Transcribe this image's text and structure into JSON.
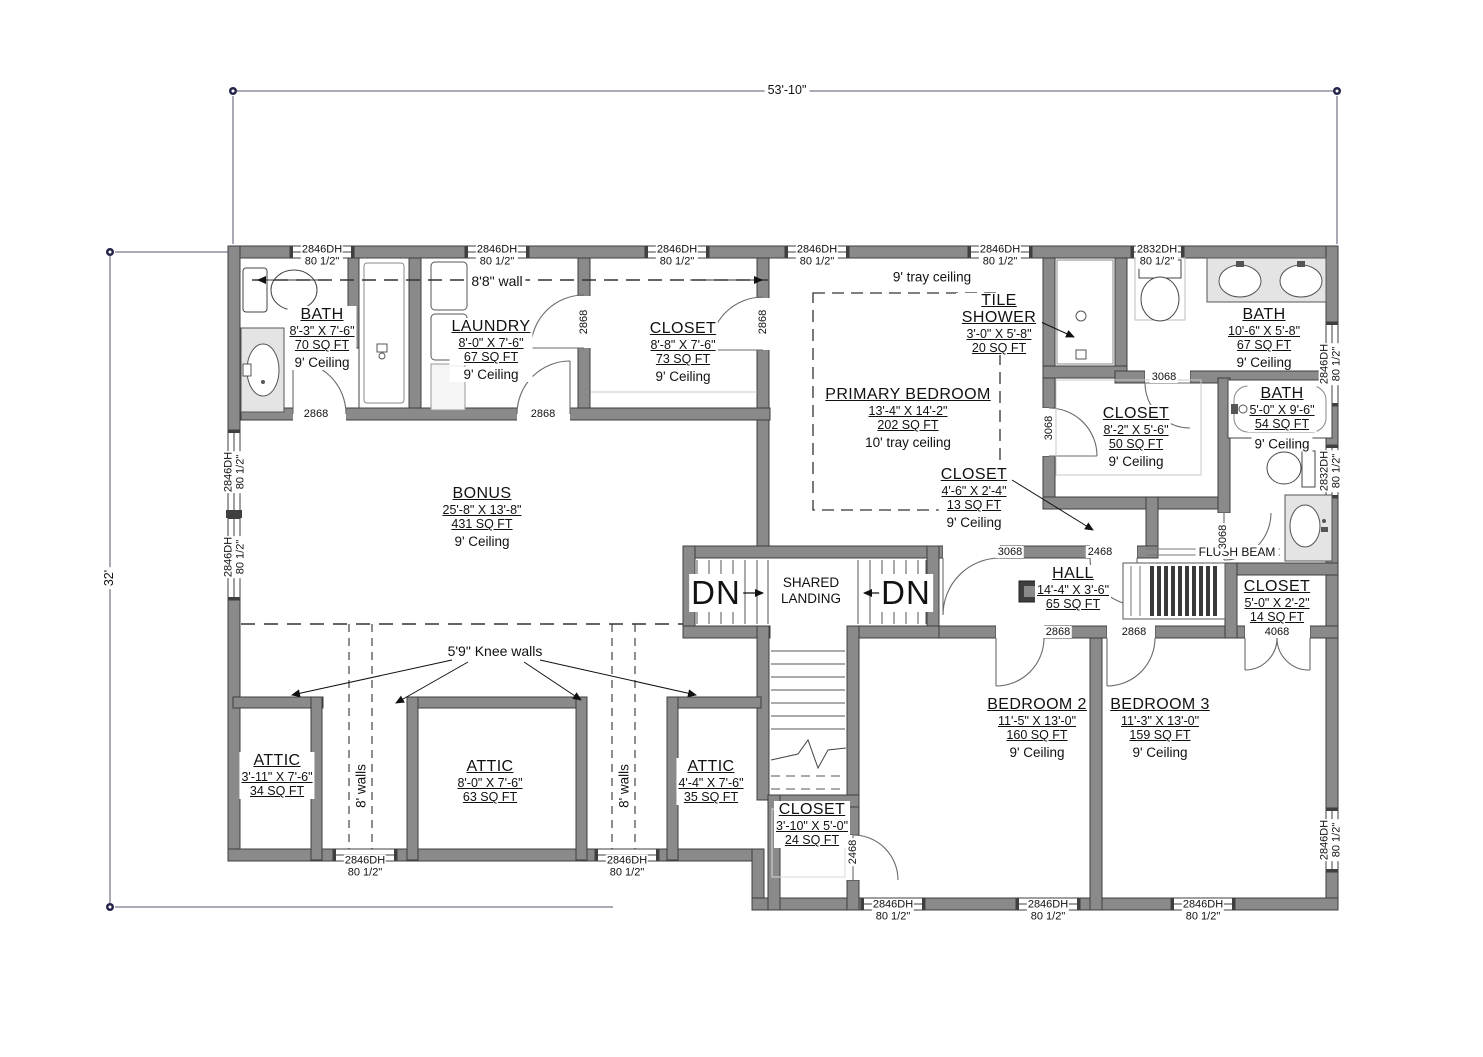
{
  "plan": {
    "overall_width": "53'-10\"",
    "overall_height": "32'"
  },
  "rooms": {
    "bath1": {
      "name": "BATH",
      "size": "8'-3\" X 7'-6\"",
      "area": "70 SQ FT",
      "ceiling": "9' Ceiling"
    },
    "laundry": {
      "name": "LAUNDRY",
      "size": "8'-0\" X 7'-6\"",
      "area": "67 SQ FT",
      "ceiling": "9' Ceiling"
    },
    "closet1": {
      "name": "CLOSET",
      "size": "8'-8\" X 7'-6\"",
      "area": "73 SQ FT",
      "ceiling": "9' Ceiling"
    },
    "primary_bedroom": {
      "name": "PRIMARY BEDROOM",
      "size": "13'-4\" X 14'-2\"",
      "area": "202 SQ FT",
      "ceiling": "10' tray ceiling",
      "note": "9' tray ceiling"
    },
    "tile_shower": {
      "name": "TILE SHOWER",
      "size": "3'-0\" X 5'-8\"",
      "area": "20 SQ FT"
    },
    "bath2": {
      "name": "BATH",
      "size": "10'-6\" X 5'-8\"",
      "area": "67 SQ FT",
      "ceiling": "9' Ceiling"
    },
    "closet2": {
      "name": "CLOSET",
      "size": "8'-2\" X 5'-6\"",
      "area": "50 SQ FT",
      "ceiling": "9' Ceiling"
    },
    "bath3": {
      "name": "BATH",
      "size": "5'-0\" X 9'-6\"",
      "area": "54 SQ FT",
      "ceiling": "9' Ceiling"
    },
    "closet3": {
      "name": "CLOSET",
      "size": "4'-6\" X 2'-4\"",
      "area": "13 SQ FT",
      "ceiling": "9' Ceiling"
    },
    "hall": {
      "name": "HALL",
      "size": "14'-4\" X 3'-6\"",
      "area": "65 SQ FT"
    },
    "closet4": {
      "name": "CLOSET",
      "size": "5'-0\" X 2'-2\"",
      "area": "14 SQ FT"
    },
    "bonus": {
      "name": "BONUS",
      "size": "25'-8\" X 13'-8\"",
      "area": "431 SQ FT",
      "ceiling": "9' Ceiling"
    },
    "attic1": {
      "name": "ATTIC",
      "size": "3'-11\" X 7'-6\"",
      "area": "34 SQ FT"
    },
    "attic2": {
      "name": "ATTIC",
      "size": "8'-0\" X 7'-6\"",
      "area": "63 SQ FT"
    },
    "attic3": {
      "name": "ATTIC",
      "size": "4'-4\" X 7'-6\"",
      "area": "35 SQ FT"
    },
    "closet5": {
      "name": "CLOSET",
      "size": "3'-10\" X 5'-0\"",
      "area": "24 SQ FT"
    },
    "bedroom2": {
      "name": "BEDROOM 2",
      "size": "11'-5\" X 13'-0\"",
      "area": "160 SQ FT",
      "ceiling": "9' Ceiling"
    },
    "bedroom3": {
      "name": "BEDROOM 3",
      "size": "11'-3\" X 13'-0\"",
      "area": "159 SQ FT",
      "ceiling": "9' Ceiling"
    },
    "landing": {
      "name": "SHARED LANDING"
    }
  },
  "labels": {
    "dn": "DN",
    "wall_height_note": "8'8\" wall",
    "tray_note": "9' tray ceiling",
    "knee_note": "5'9\" Knee walls",
    "attic_walls_note": "8' walls",
    "flush_beam": "FLUSH BEAM"
  },
  "windows": {
    "w2846": {
      "model": "2846DH",
      "header": "80 1/2\""
    },
    "w2832": {
      "model": "2832DH",
      "header": "80 1/2\""
    }
  },
  "doors": {
    "d2868": "2868",
    "d3068": "3068",
    "d2468": "2468",
    "d4068": "4068"
  },
  "colors": {
    "wall_fill": "#8a8a8a",
    "wall_edge": "#3f3f3f",
    "fixture_fill": "#e4e4e4",
    "dim_marker": "#24244a"
  }
}
